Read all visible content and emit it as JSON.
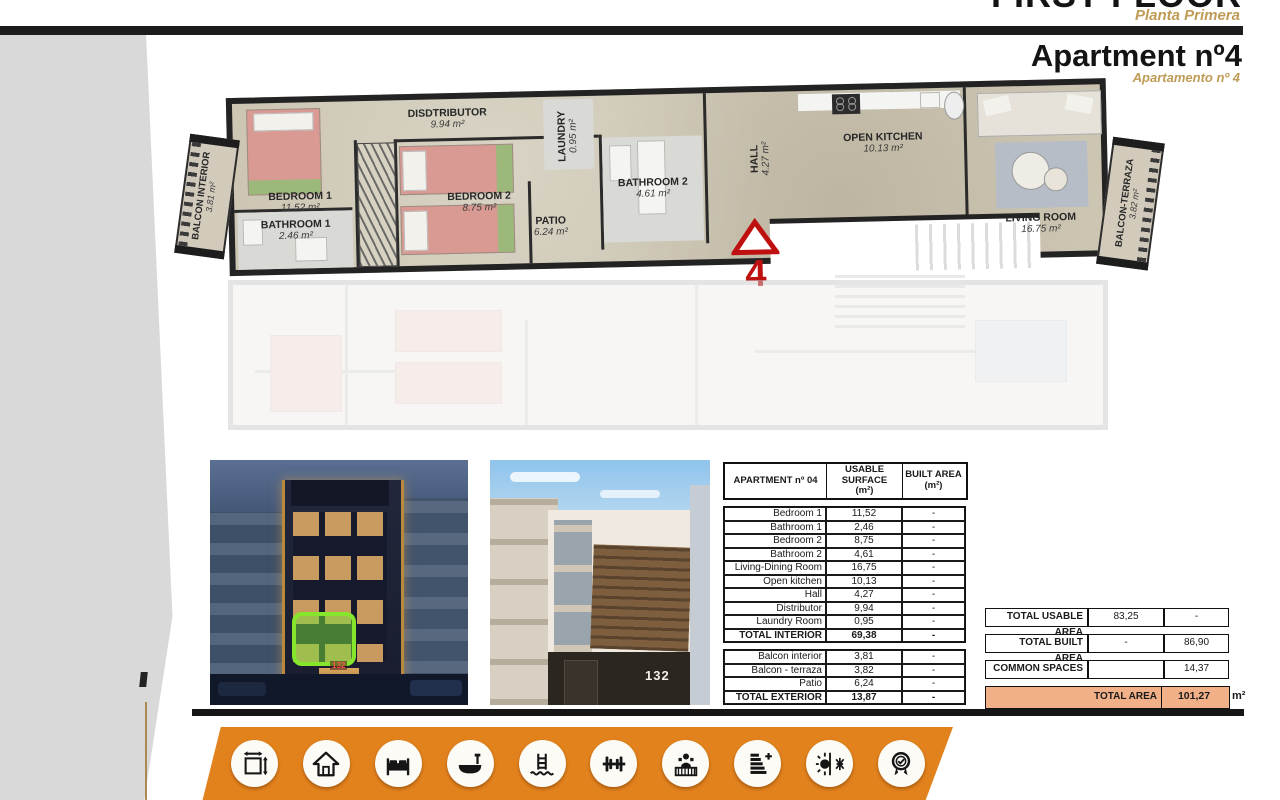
{
  "header": {
    "floor_title": "FIRST FLOOR",
    "floor_subtitle": "Planta Primera",
    "apartment_title": "Apartment nº4",
    "apartment_subtitle": "Apartamento nº 4"
  },
  "floor_plan": {
    "unit_number": "4",
    "rooms": [
      {
        "name": "BEDROOM 1",
        "area": "11.52 m²"
      },
      {
        "name": "BATHROOM 1",
        "area": "2.46 m²"
      },
      {
        "name": "DISDTRIBUTOR",
        "area": "9.94 m²"
      },
      {
        "name": "BEDROOM 2",
        "area": "8.75 m²"
      },
      {
        "name": "PATIO",
        "area": "6.24 m²"
      },
      {
        "name": "LAUNDRY",
        "area": "0.95 m²"
      },
      {
        "name": "BATHROOM 2",
        "area": "4.61 m²"
      },
      {
        "name": "HALL",
        "area": "4.27 m²"
      },
      {
        "name": "OPEN KITCHEN",
        "area": "10.13 m²"
      },
      {
        "name": "LIVING ROOM",
        "area": "16.75 m²"
      },
      {
        "name": "BALCON INTERIOR",
        "area": "3.81 m²"
      },
      {
        "name": "BALCON-TERRAZA",
        "area": "3.82 m²"
      }
    ]
  },
  "photos": {
    "night_building_sign": "132",
    "day_building_sign": "132"
  },
  "area_table": {
    "header": {
      "col1": "APARTMENT nº 04",
      "col2a": "USABLE SURFACE",
      "col2b": "(m²)",
      "col3a": "BUILT AREA",
      "col3b": "(m²)"
    },
    "interior_rows": [
      [
        "Bedroom 1",
        "11,52",
        "-"
      ],
      [
        "Bathroom 1",
        "2,46",
        "-"
      ],
      [
        "Bedroom 2",
        "8,75",
        "-"
      ],
      [
        "Bathroom 2",
        "4,61",
        "-"
      ],
      [
        "Living-Dining Room",
        "16,75",
        "-"
      ],
      [
        "Open kitchen",
        "10,13",
        "-"
      ],
      [
        "Hall",
        "4,27",
        "-"
      ],
      [
        "Distributor",
        "9,94",
        "-"
      ],
      [
        "Laundry Room",
        "0,95",
        "-"
      ],
      [
        "TOTAL INTERIOR",
        "69,38",
        "-"
      ]
    ],
    "exterior_rows": [
      [
        "Balcon interior",
        "3,81",
        "-"
      ],
      [
        "Balcon - terraza",
        "3,82",
        "-"
      ],
      [
        "Patio",
        "6,24",
        "-"
      ],
      [
        "TOTAL EXTERIOR",
        "13,87",
        "-"
      ]
    ]
  },
  "summary": {
    "rows": [
      {
        "label": "TOTAL USABLE AREA",
        "usable": "83,25",
        "built": "-"
      },
      {
        "label": "TOTAL BUILT AREA",
        "usable": "-",
        "built": "86,90"
      },
      {
        "label": "COMMON SPACES",
        "usable": "",
        "built": "14,37"
      }
    ],
    "total": {
      "label": "TOTAL AREA",
      "value": "101,27",
      "unit": "m²"
    }
  },
  "amenities": {
    "icons": [
      "dimensions",
      "house",
      "bedrooms",
      "bathtub",
      "pool",
      "gym",
      "reception",
      "energy-rating",
      "climate",
      "quality-badge"
    ]
  },
  "colors": {
    "accent_orange": "#e2821d",
    "light_orange": "#f2b088",
    "gold": "#bf9b56",
    "plan_red": "#bf1010"
  }
}
